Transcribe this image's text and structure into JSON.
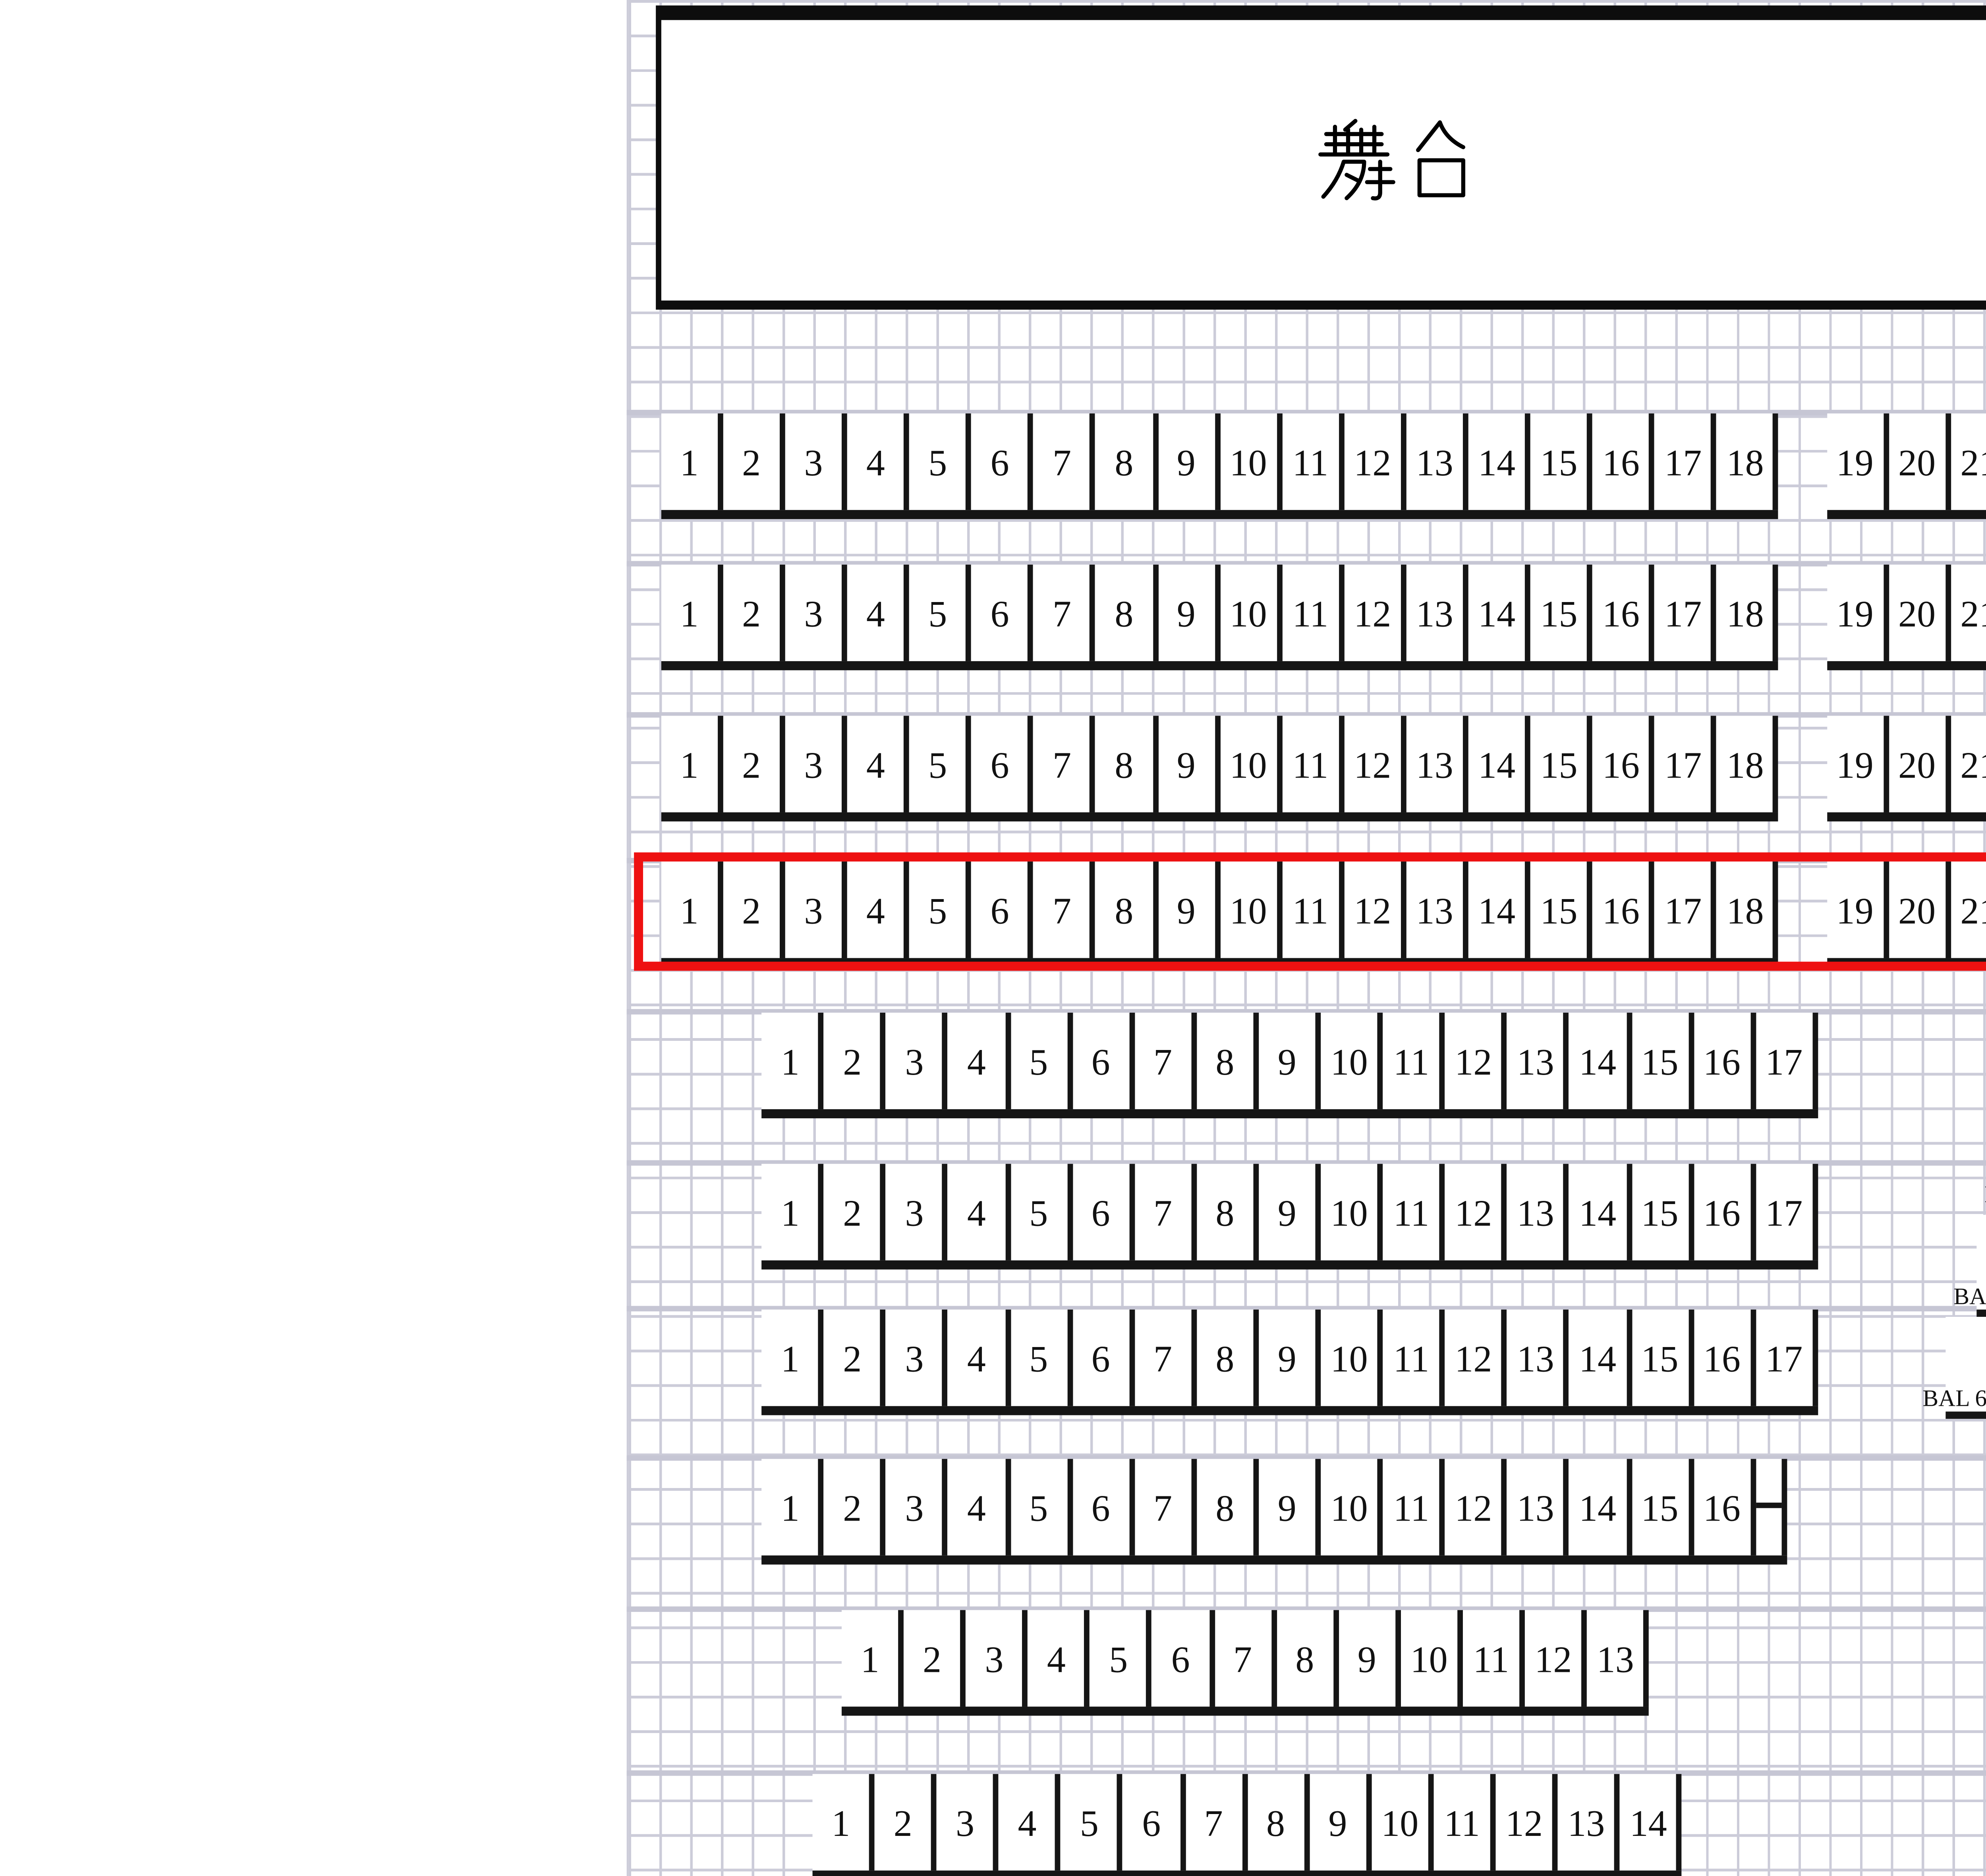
{
  "stage": {
    "label": "舞台"
  },
  "rows": [
    {
      "name": "row-1",
      "highlighted": false,
      "groups": [
        {
          "seats": [
            "1",
            "2",
            "3",
            "4",
            "5",
            "6",
            "7",
            "8",
            "9",
            "10",
            "11",
            "12",
            "13",
            "14",
            "15",
            "16",
            "17",
            "18"
          ]
        },
        {
          "seats": [
            "19",
            "20",
            "21",
            "22"
          ]
        }
      ]
    },
    {
      "name": "row-2",
      "highlighted": false,
      "groups": [
        {
          "seats": [
            "1",
            "2",
            "3",
            "4",
            "5",
            "6",
            "7",
            "8",
            "9",
            "10",
            "11",
            "12",
            "13",
            "14",
            "15",
            "16",
            "17",
            "18"
          ]
        },
        {
          "seats": [
            "19",
            "20",
            "21"
          ]
        }
      ]
    },
    {
      "name": "row-3",
      "highlighted": false,
      "groups": [
        {
          "seats": [
            "1",
            "2",
            "3",
            "4",
            "5",
            "6",
            "7",
            "8",
            "9",
            "10",
            "11",
            "12",
            "13",
            "14",
            "15",
            "16",
            "17",
            "18"
          ]
        },
        {
          "seats": [
            "19",
            "20",
            "21"
          ]
        }
      ]
    },
    {
      "name": "row-4",
      "highlighted": true,
      "groups": [
        {
          "seats": [
            "1",
            "2",
            "3",
            "4",
            "5",
            "6",
            "7",
            "8",
            "9",
            "10",
            "11",
            "12",
            "13",
            "14",
            "15",
            "16",
            "17",
            "18"
          ]
        },
        {
          "seats": [
            "19",
            "20",
            "21"
          ]
        }
      ]
    },
    {
      "name": "row-5",
      "highlighted": false,
      "groups": [
        {
          "seats": [
            "1",
            "2",
            "3",
            "4",
            "5",
            "6",
            "7",
            "8",
            "9",
            "10",
            "11",
            "12",
            "13",
            "14",
            "15",
            "16",
            "17"
          ]
        }
      ]
    },
    {
      "name": "row-6",
      "highlighted": false,
      "groups": [
        {
          "seats": [
            "1",
            "2",
            "3",
            "4",
            "5",
            "6",
            "7",
            "8",
            "9",
            "10",
            "11",
            "12",
            "13",
            "14",
            "15",
            "16",
            "17"
          ]
        }
      ]
    },
    {
      "name": "row-7",
      "highlighted": false,
      "groups": [
        {
          "seats": [
            "1",
            "2",
            "3",
            "4",
            "5",
            "6",
            "7",
            "8",
            "9",
            "10",
            "11",
            "12",
            "13",
            "14",
            "15",
            "16",
            "17"
          ]
        }
      ]
    },
    {
      "name": "row-8",
      "highlighted": false,
      "groups": [
        {
          "seats": [
            "1",
            "2",
            "3",
            "4",
            "5",
            "6",
            "7",
            "8",
            "9",
            "10",
            "11",
            "12",
            "13",
            "14",
            "15",
            "16"
          ],
          "notch": true
        }
      ]
    },
    {
      "name": "row-9",
      "highlighted": false,
      "groups": [
        {
          "seats": [
            "1",
            "2",
            "3",
            "4",
            "5",
            "6",
            "7",
            "8",
            "9",
            "10",
            "11",
            "12",
            "13"
          ]
        }
      ]
    },
    {
      "name": "row-10",
      "highlighted": false,
      "groups": [
        {
          "seats": [
            "1",
            "2",
            "3",
            "4",
            "5",
            "6",
            "7",
            "8",
            "9",
            "10",
            "11",
            "12",
            "13",
            "14"
          ]
        }
      ]
    }
  ],
  "balconies": [
    {
      "label": "BAL 1"
    },
    {
      "label": "BAL 2"
    },
    {
      "label": "BAL 3"
    },
    {
      "label": "BAL 4"
    },
    {
      "label": "BAL 5"
    },
    {
      "label": "BAL 6"
    }
  ],
  "colors": {
    "highlight": "#ee1111",
    "grid_line": "#ccccd9",
    "seat_border": "#151515",
    "row_band": "#c6c6d4"
  }
}
